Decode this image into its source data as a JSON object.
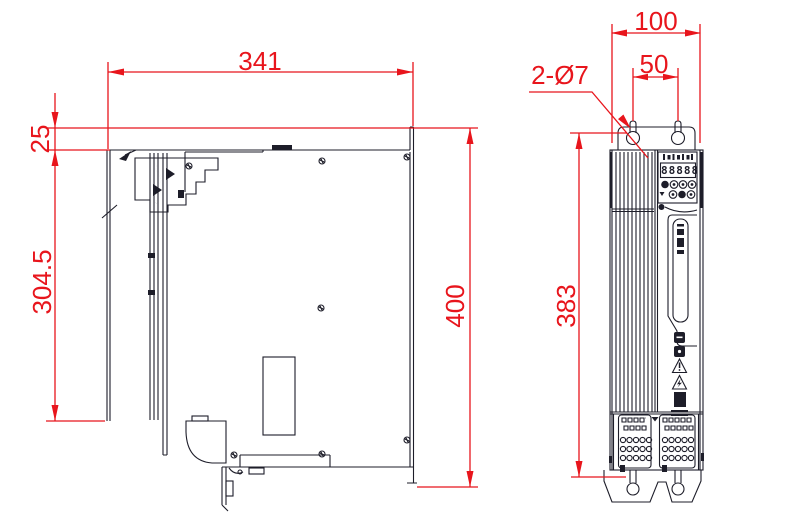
{
  "colors": {
    "dimension_red": "#e8151c",
    "line_dark": "#1d1d29",
    "background": "#ffffff"
  },
  "views": {
    "side_view": {
      "dimensions": {
        "width": "341",
        "top_offset": "25",
        "body_height": "304.5",
        "overall_height": "400"
      }
    },
    "front_view": {
      "dimensions": {
        "width": "100",
        "hole_spacing": "50",
        "mounting_hole_callout": "2-Ø7",
        "mounting_height": "383"
      },
      "display_value": "88888"
    }
  }
}
